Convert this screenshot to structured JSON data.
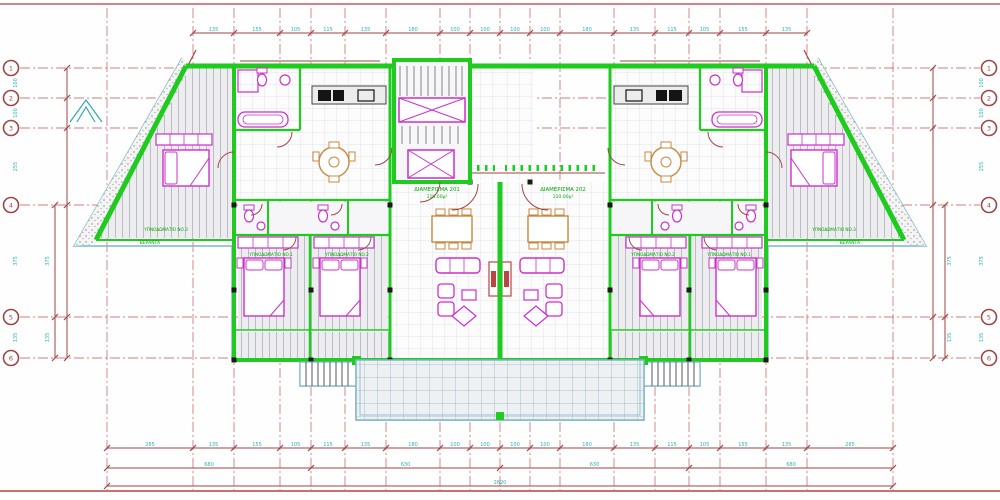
{
  "colors": {
    "wall_green": "#1ecb1e",
    "furniture_magenta": "#cc2fcc",
    "dimension_red": "#a04545",
    "grid_line_red": "#c65b5b",
    "dimension_text_cyan": "#2ab5b5",
    "slab_outline_cyan": "#7fb6c6",
    "wood_orange": "#c8873f",
    "room_label_green": "#00a300",
    "floor_hatch_gray": "#b9bdc6",
    "fixture_black": "#1a1a1a"
  },
  "grid": {
    "row_labels": [
      "1",
      "2",
      "3",
      "4",
      "5",
      "6"
    ]
  },
  "labels": {
    "apartment_left_name": "ΔΙΑΜΕΡΙΣΜΑ 201",
    "apartment_left_area": "110.00μ²",
    "apartment_right_name": "ΔΙΑΜΕΡΙΣΜΑ 202",
    "apartment_right_area": "110.00μ²",
    "bedroom1_left": "ΥΠΝΟΔΩΜΑΤΙΟ ΝΟ.1",
    "bedroom2_left": "ΥΠΝΟΔΩΜΑΤΙΟ ΝΟ.2",
    "bedroom2_right": "ΥΠΝΟΔΩΜΑΤΙΟ ΝΟ.2",
    "bedroom1_right": "ΥΠΝΟΔΩΜΑΤΙΟ ΝΟ.1",
    "bedroom3_left": "ΥΠΝΟΔΩΜΑΤΙΟ ΝΟ.3",
    "bedroom3_right": "ΥΠΝΟΔΩΜΑΤΙΟ ΝΟ.3",
    "veranda_left": "ΒΕΡΑΝΤΑ",
    "veranda_right": "ΒΕΡΑΝΤΑ"
  },
  "dimensions": {
    "top": [
      "135",
      "155",
      "105",
      "115",
      "135",
      "180",
      "100",
      "100",
      "100",
      "100",
      "180",
      "135",
      "115",
      "105",
      "155",
      "135"
    ],
    "bottom_segments": [
      "285",
      "135",
      "155",
      "105",
      "115",
      "135",
      "180",
      "100",
      "100",
      "100",
      "100",
      "180",
      "135",
      "115",
      "105",
      "155",
      "135",
      "285"
    ],
    "bottom_subtotals": [
      "680",
      "630",
      "630",
      "680"
    ],
    "bottom_total": [
      "2620"
    ],
    "left_outer": [
      "100",
      "100",
      "255",
      "375",
      "135"
    ],
    "left_inner": [
      "375",
      "135"
    ],
    "right_outer": [
      "100",
      "100",
      "255",
      "375",
      "135"
    ],
    "right_inner": [
      "375",
      "135"
    ]
  }
}
